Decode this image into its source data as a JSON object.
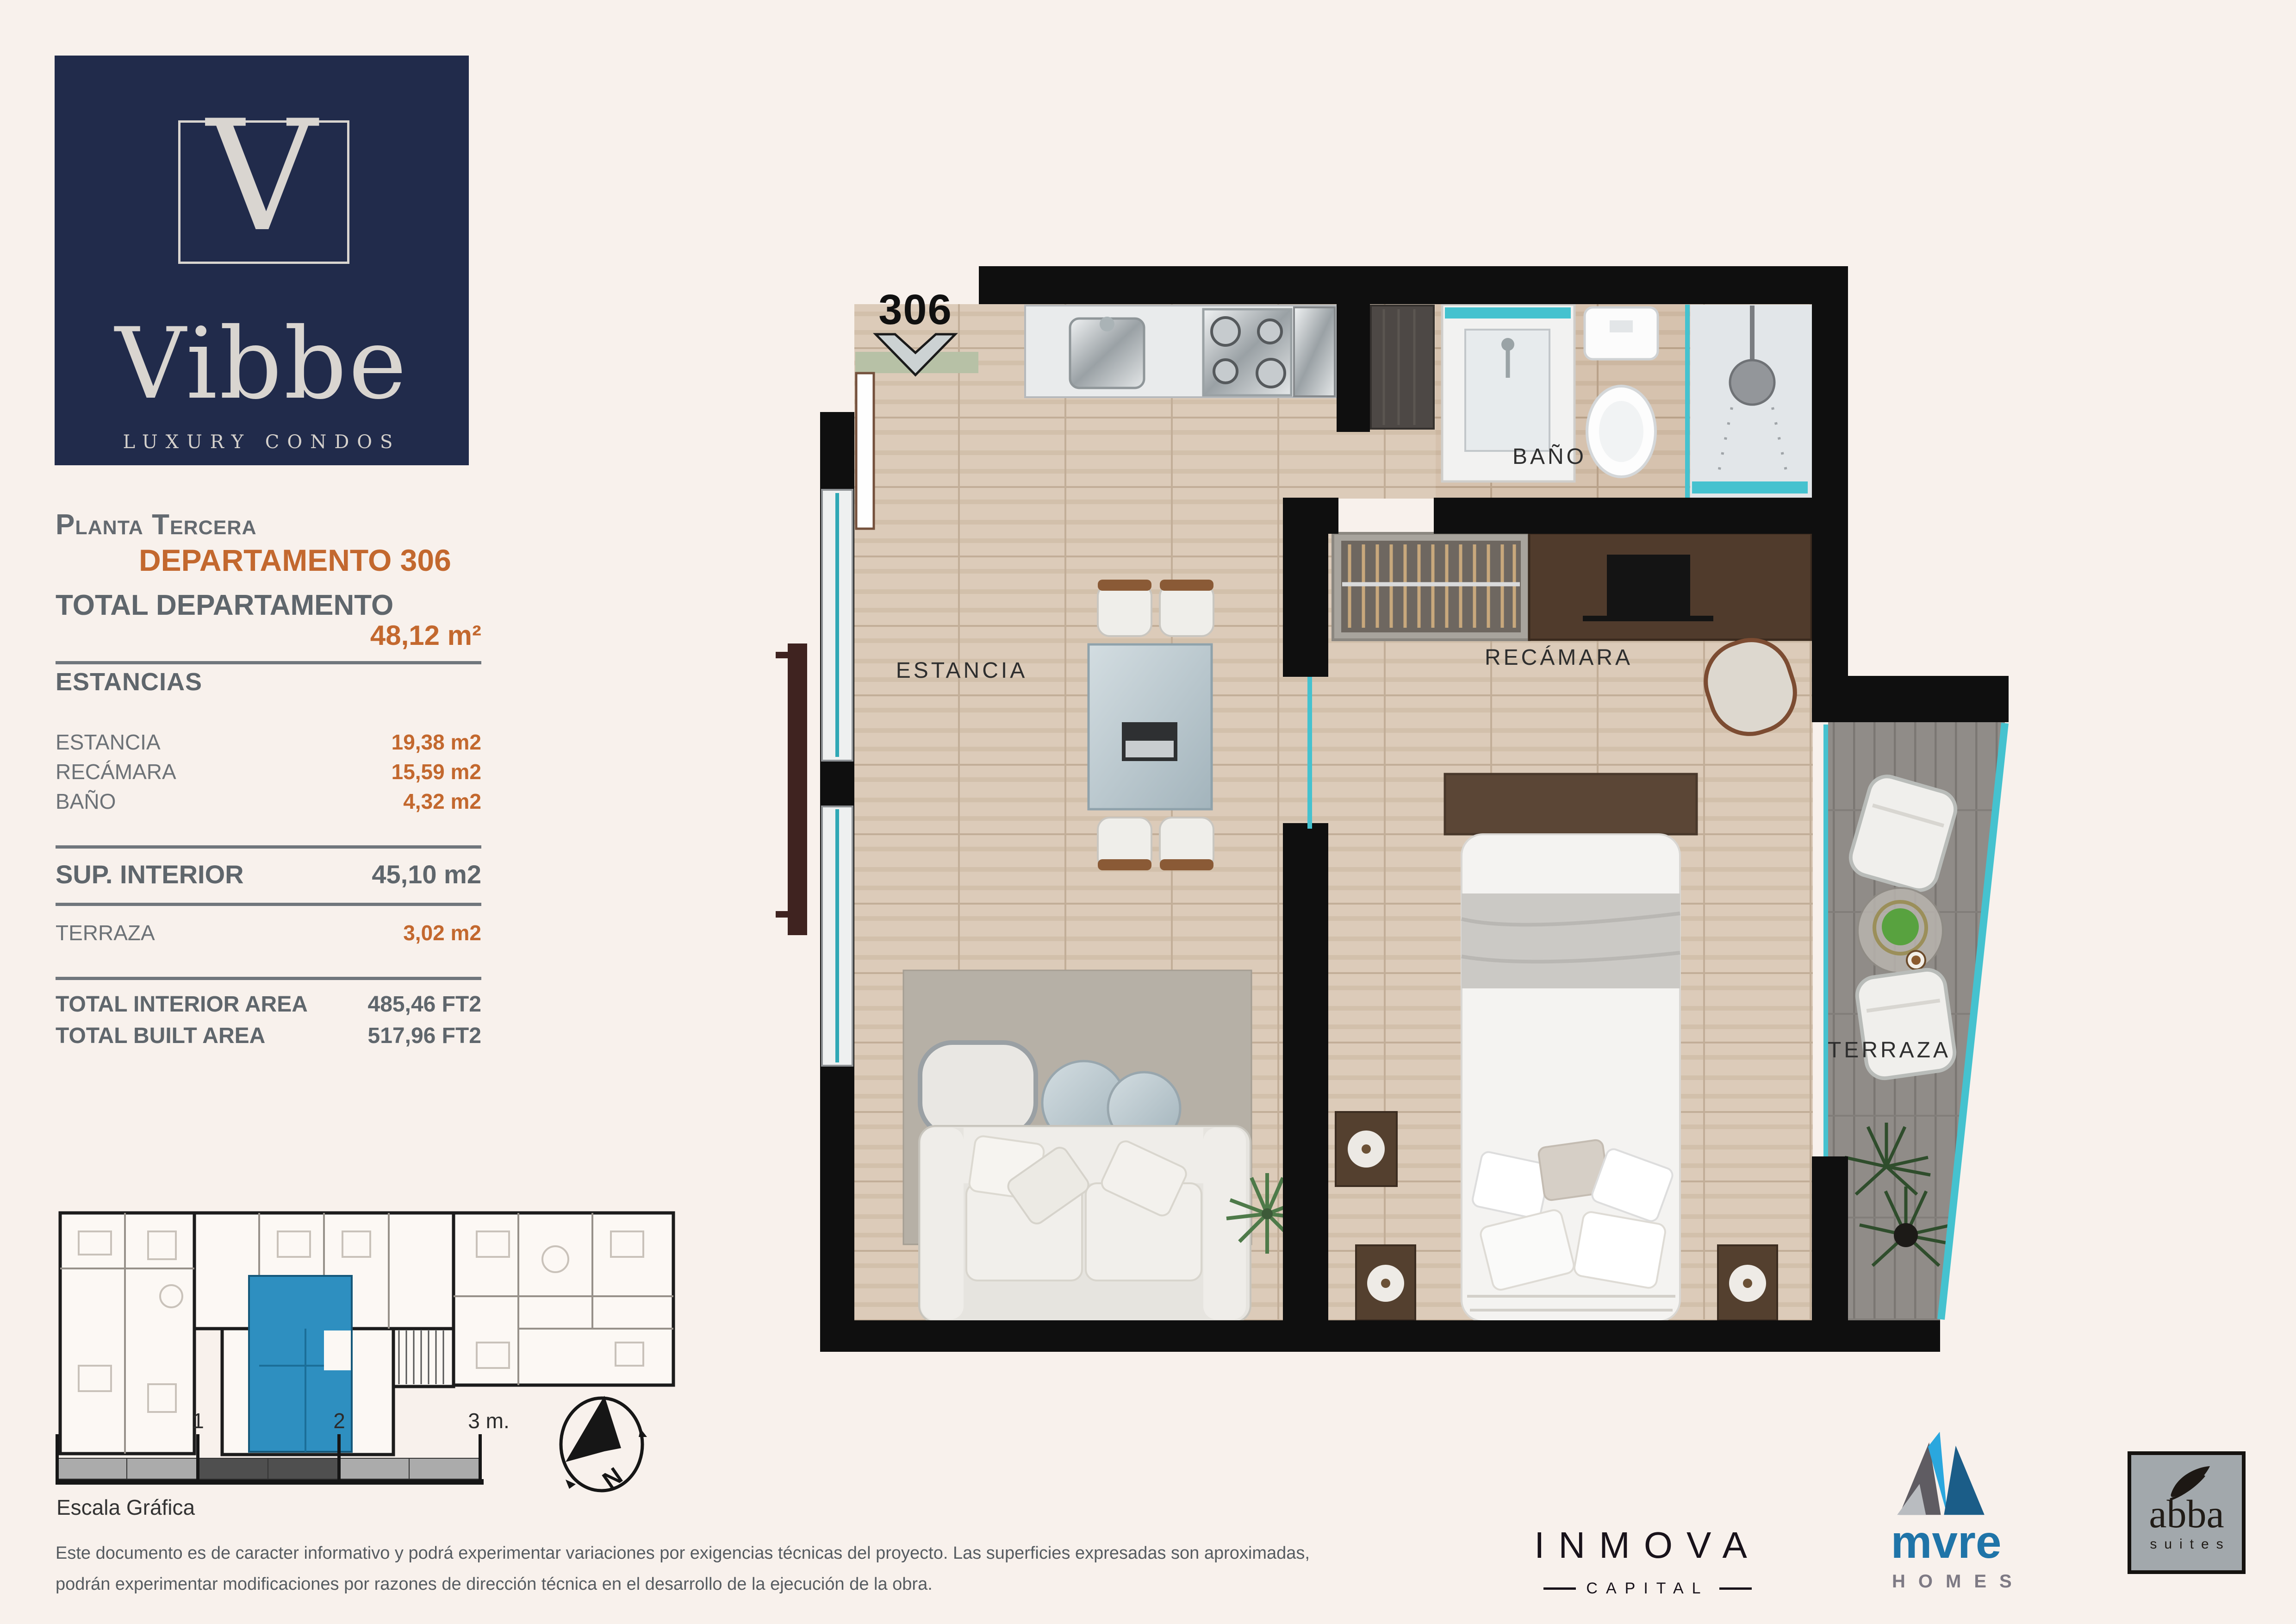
{
  "brand": {
    "logo_letter": "V",
    "name": "Vibbe",
    "tagline": "LUXURY CONDOS"
  },
  "header": {
    "floor": "Planta Tercera",
    "unit": "DEPARTAMENTO 306"
  },
  "summary": {
    "total_label": "TOTAL DEPARTAMENTO",
    "total_value": "48,12 m²",
    "rooms_header": "ESTANCIAS",
    "rooms": [
      {
        "label": "ESTANCIA",
        "value": "19,38 m2"
      },
      {
        "label": "RECÁMARA",
        "value": "15,59 m2"
      },
      {
        "label": "BAÑO",
        "value": "4,32 m2"
      }
    ],
    "sup_interior_label": "SUP. INTERIOR",
    "sup_interior_value": "45,10 m2",
    "terraza_label": "TERRAZA",
    "terraza_value": "3,02 m2",
    "totals": [
      {
        "label": "TOTAL INTERIOR AREA",
        "value": "485,46 FT2"
      },
      {
        "label": "TOTAL BUILT AREA",
        "value": "517,96 FT2"
      }
    ]
  },
  "plan": {
    "unit_number": "306",
    "rooms": {
      "estancia": "ESTANCIA",
      "bano": "BAÑO",
      "recamara": "RECÁMARA",
      "terraza": "TERRAZA"
    }
  },
  "scale": {
    "ticks": [
      "1",
      "2",
      "3 m."
    ],
    "caption": "Escala Gráfica"
  },
  "compass": {
    "letter": "N"
  },
  "disclaimer": {
    "line1": "Este documento es de caracter informativo y podrá experimentar variaciones por exigencias técnicas del proyecto. Las superficies expresadas son aproximadas,",
    "line2": "podrán experimentar modificaciones por razones de dirección técnica en el desarrollo de la ejecución de la obra."
  },
  "partners": {
    "inmova": {
      "name": "INMOVA",
      "sub": "CAPITAL"
    },
    "mvre": {
      "name": "mvre",
      "sub": "HOMES"
    },
    "abba": {
      "name": "abba",
      "sub": "suites"
    }
  },
  "colors": {
    "accent_orange": "#c3682e",
    "navy": "#212b4b",
    "teal_glass": "#45c2cf",
    "unit_highlight_blue": "#2e8fc0",
    "mvre_blue": "#1f74a8",
    "background": "#f8f1ec"
  }
}
